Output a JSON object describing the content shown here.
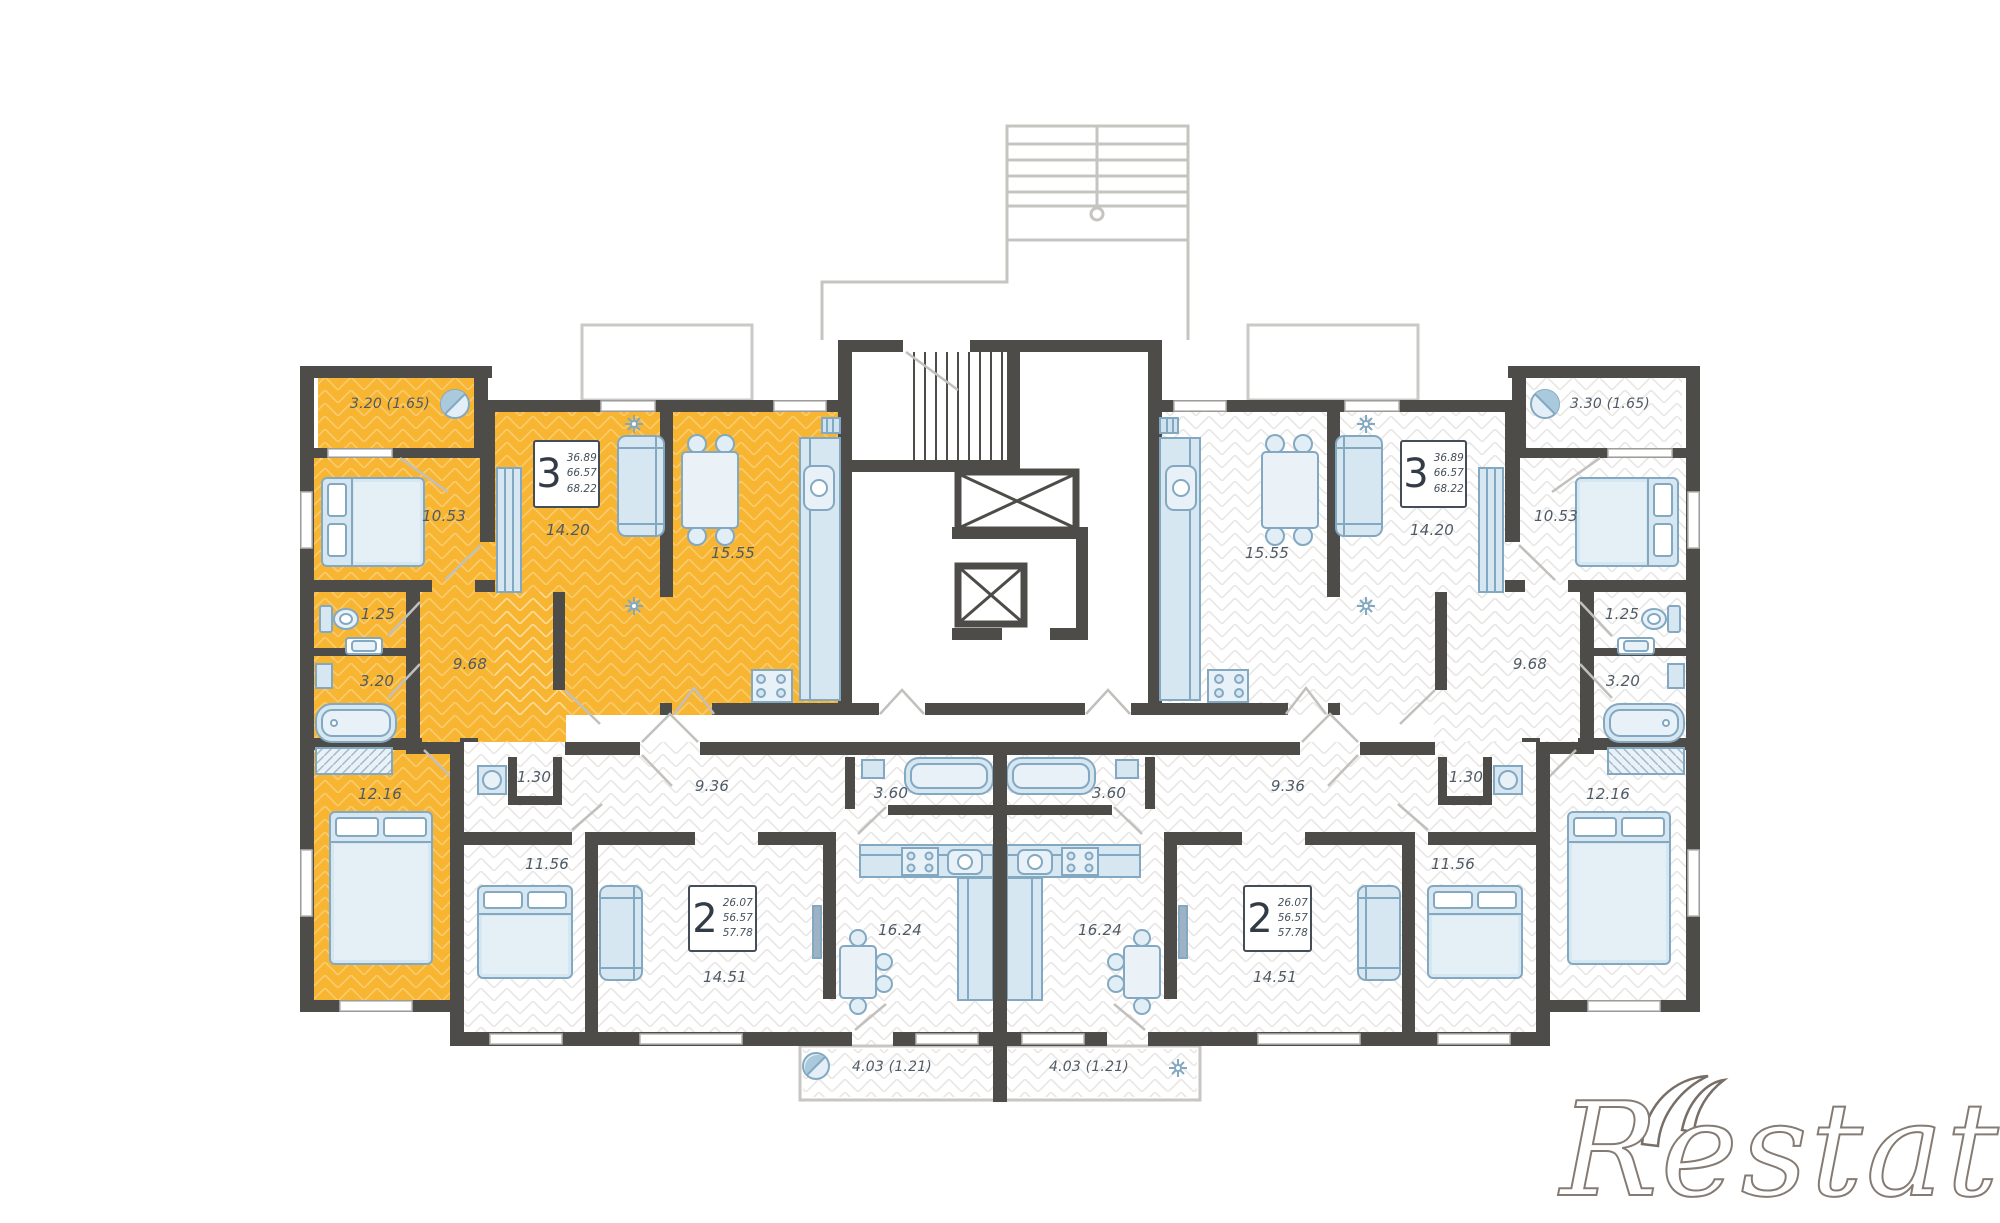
{
  "watermark": {
    "text": "Restate"
  },
  "colors": {
    "highlight": "#F7B531",
    "wall": "#4E4C48",
    "furniture_fill": "#D7E7F1",
    "furniture_stroke": "#83A9C2",
    "label_text": "#4F5A66"
  },
  "icons": {
    "balcony_icon": "porthole-icon",
    "radiator_icon": "flower-icon",
    "kitchen_vent_icon": "vent-grille-icon",
    "elevator_icon": "crossed-shaft-icon"
  },
  "apartments": {
    "left3": {
      "type_label": "3",
      "areas": [
        "36.89",
        "66.57",
        "68.22"
      ],
      "rooms": {
        "balcony": "3.20 (1.65)",
        "bedroom1": "10.53",
        "living": "14.20",
        "kitchen": "15.55",
        "wc": "1.25",
        "bath": "3.20",
        "hall": "9.68",
        "bedroom2": "12.16"
      }
    },
    "right3": {
      "type_label": "3",
      "areas": [
        "36.89",
        "66.57",
        "68.22"
      ],
      "rooms": {
        "balcony": "3.30 (1.65)",
        "bedroom1": "10.53",
        "living": "14.20",
        "kitchen": "15.55",
        "wc": "1.25",
        "bath": "3.20",
        "hall": "9.68",
        "bedroom2": "12.16"
      }
    },
    "left2": {
      "type_label": "2",
      "areas": [
        "26.07",
        "56.57",
        "57.78"
      ],
      "rooms": {
        "wc": "1.30",
        "hall": "9.36",
        "bedroom": "11.56",
        "living": "14.51",
        "kitchen": "16.24",
        "bath": "3.60",
        "balcony": "4.03 (1.21)"
      }
    },
    "right2": {
      "type_label": "2",
      "areas": [
        "26.07",
        "56.57",
        "57.78"
      ],
      "rooms": {
        "wc": "1.30",
        "hall": "9.36",
        "bedroom": "11.56",
        "living": "14.51",
        "kitchen": "16.24",
        "bath": "3.60",
        "balcony": "4.03 (1.21)"
      }
    }
  }
}
